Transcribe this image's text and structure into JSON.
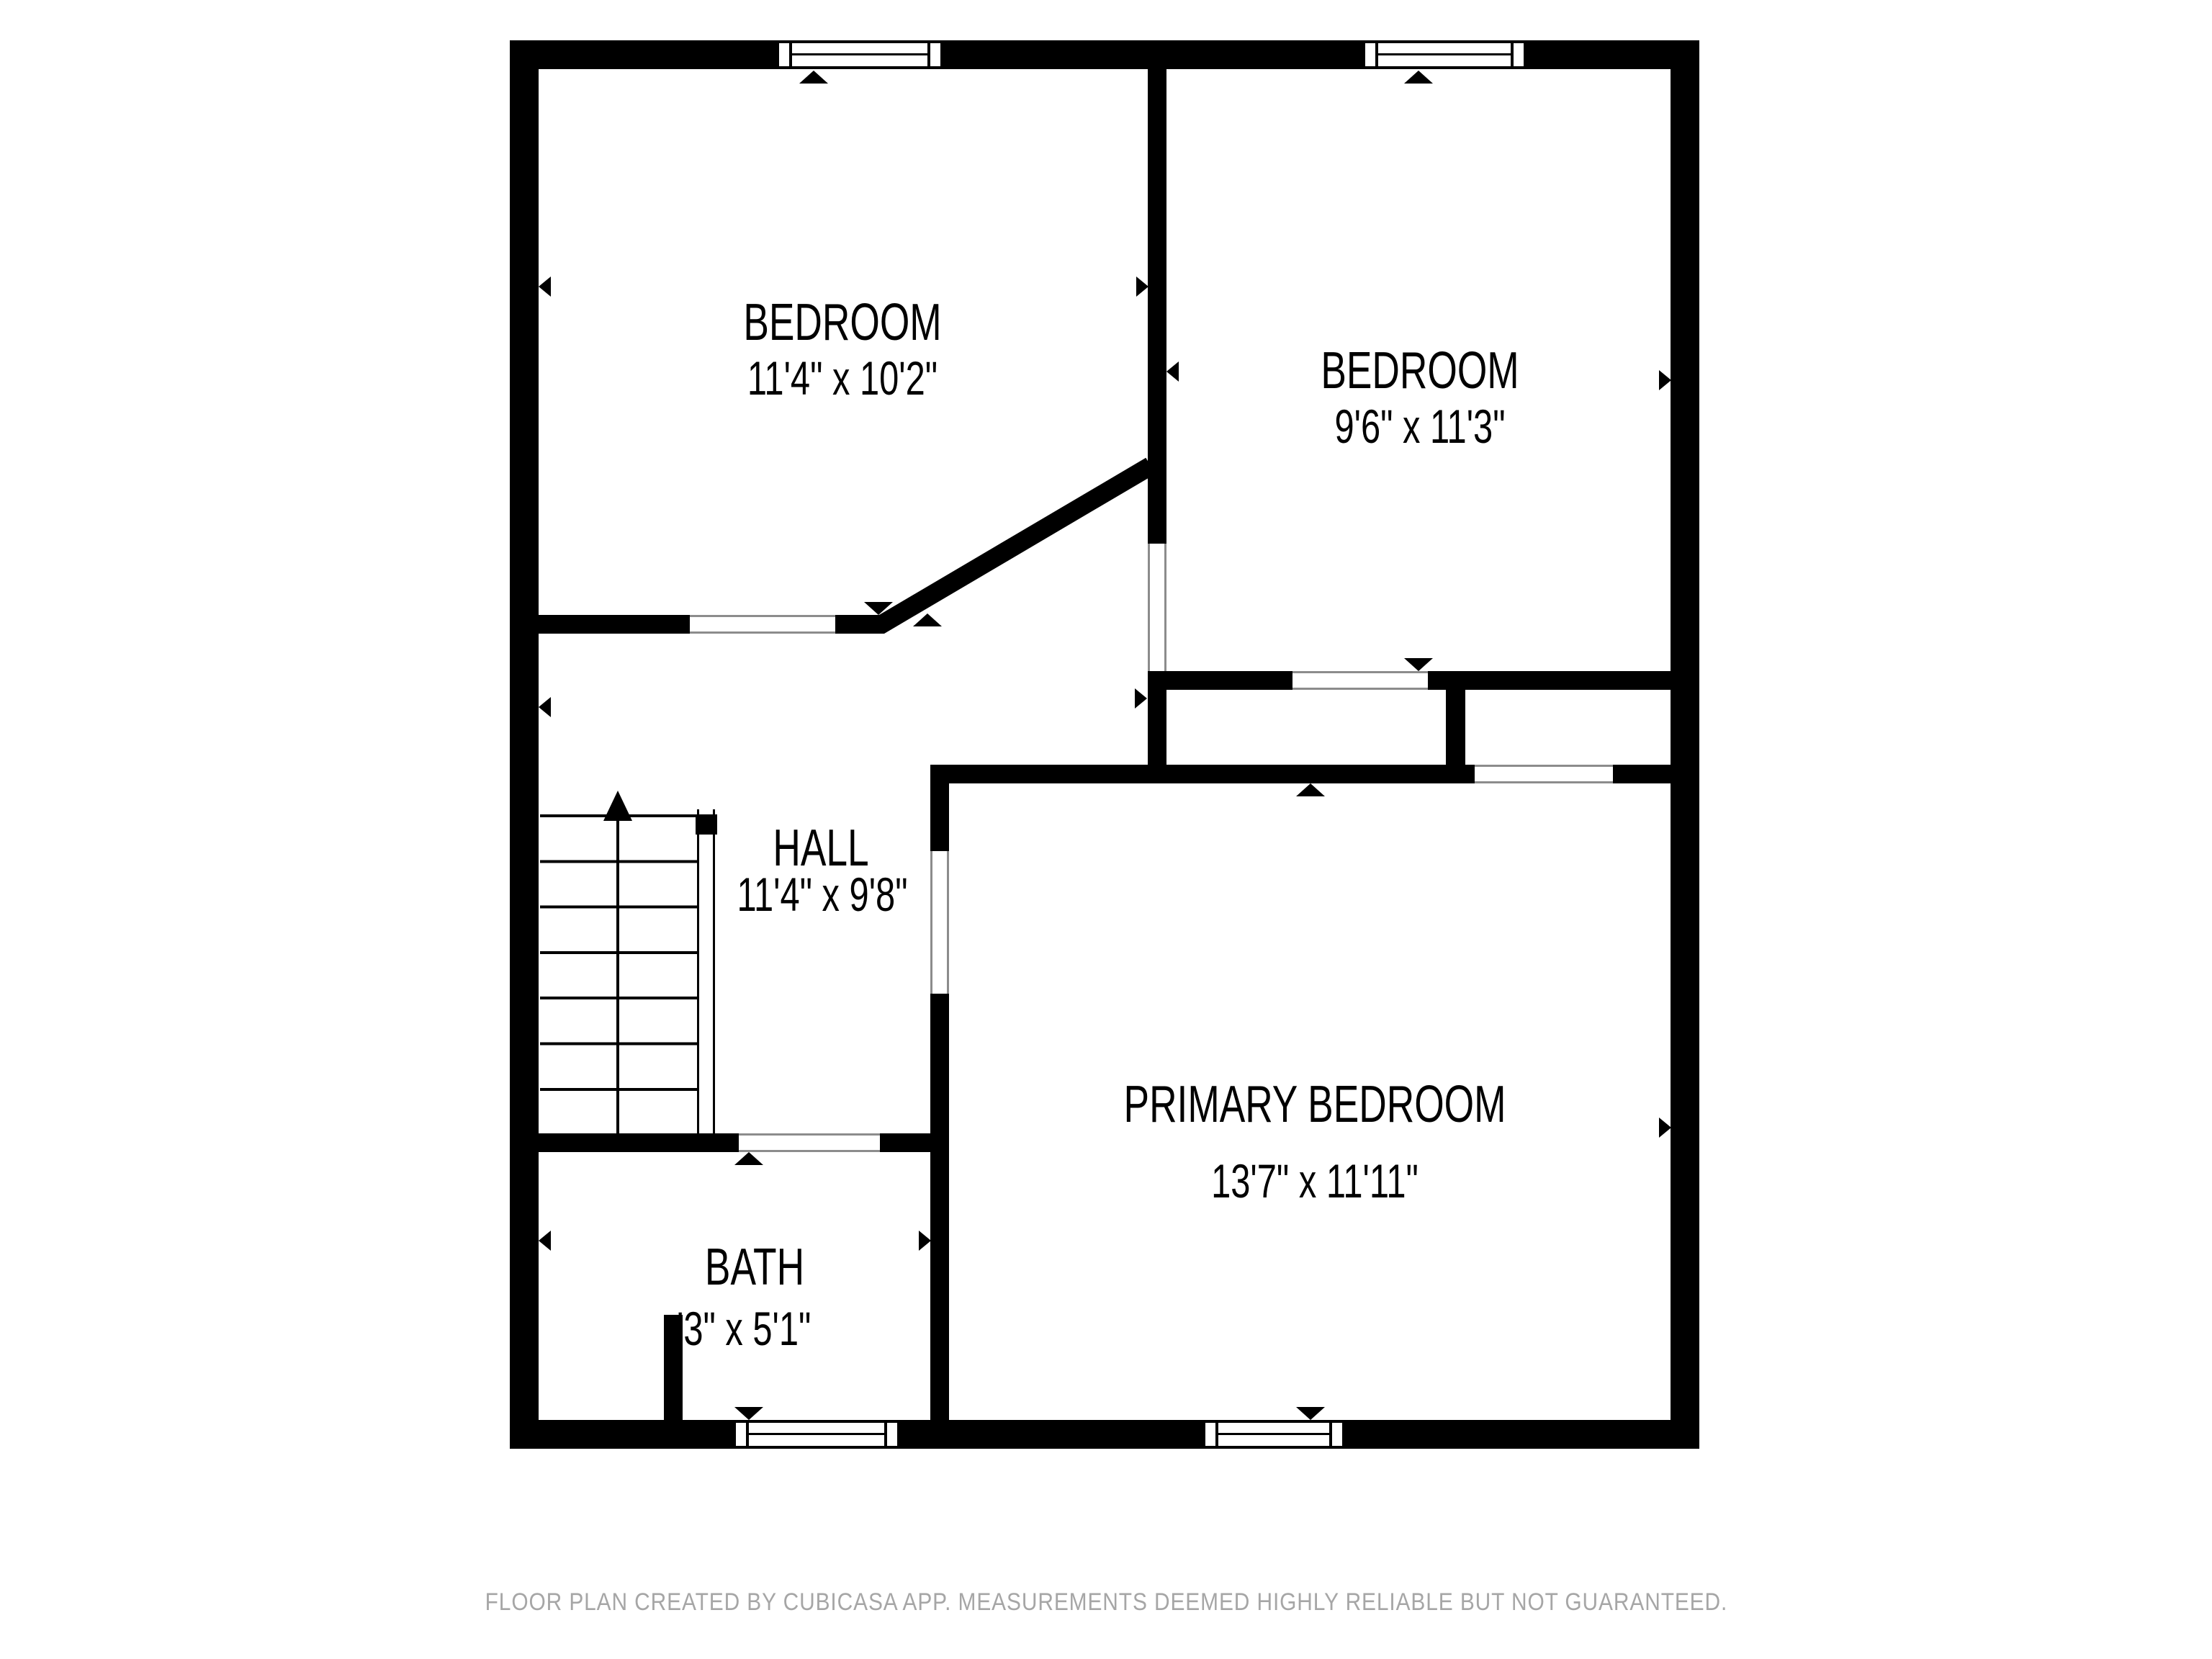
{
  "rooms": [
    {
      "id": "bedroom-top-left",
      "name": "BEDROOM",
      "dims": "11'4\" x 10'2\""
    },
    {
      "id": "bedroom-top-right",
      "name": "BEDROOM",
      "dims": "9'6\" x 11'3\""
    },
    {
      "id": "hall",
      "name": "HALL",
      "dims": "11'4\" x 9'8\""
    },
    {
      "id": "primary-bedroom",
      "name": "PRIMARY BEDROOM",
      "dims": "13'7\" x 11'11\""
    },
    {
      "id": "bath",
      "name": "BATH",
      "dims": "'3\" x 5'1\""
    }
  ],
  "footer": {
    "disclaimer": "FLOOR PLAN CREATED BY CUBICASA APP. MEASUREMENTS DEEMED HIGHLY RELIABLE BUT NOT GUARANTEED."
  },
  "colors": {
    "wall": "#000000",
    "door_frame": "#8c8c8c",
    "footer_text": "#a6a6a6",
    "background": "#ffffff"
  }
}
